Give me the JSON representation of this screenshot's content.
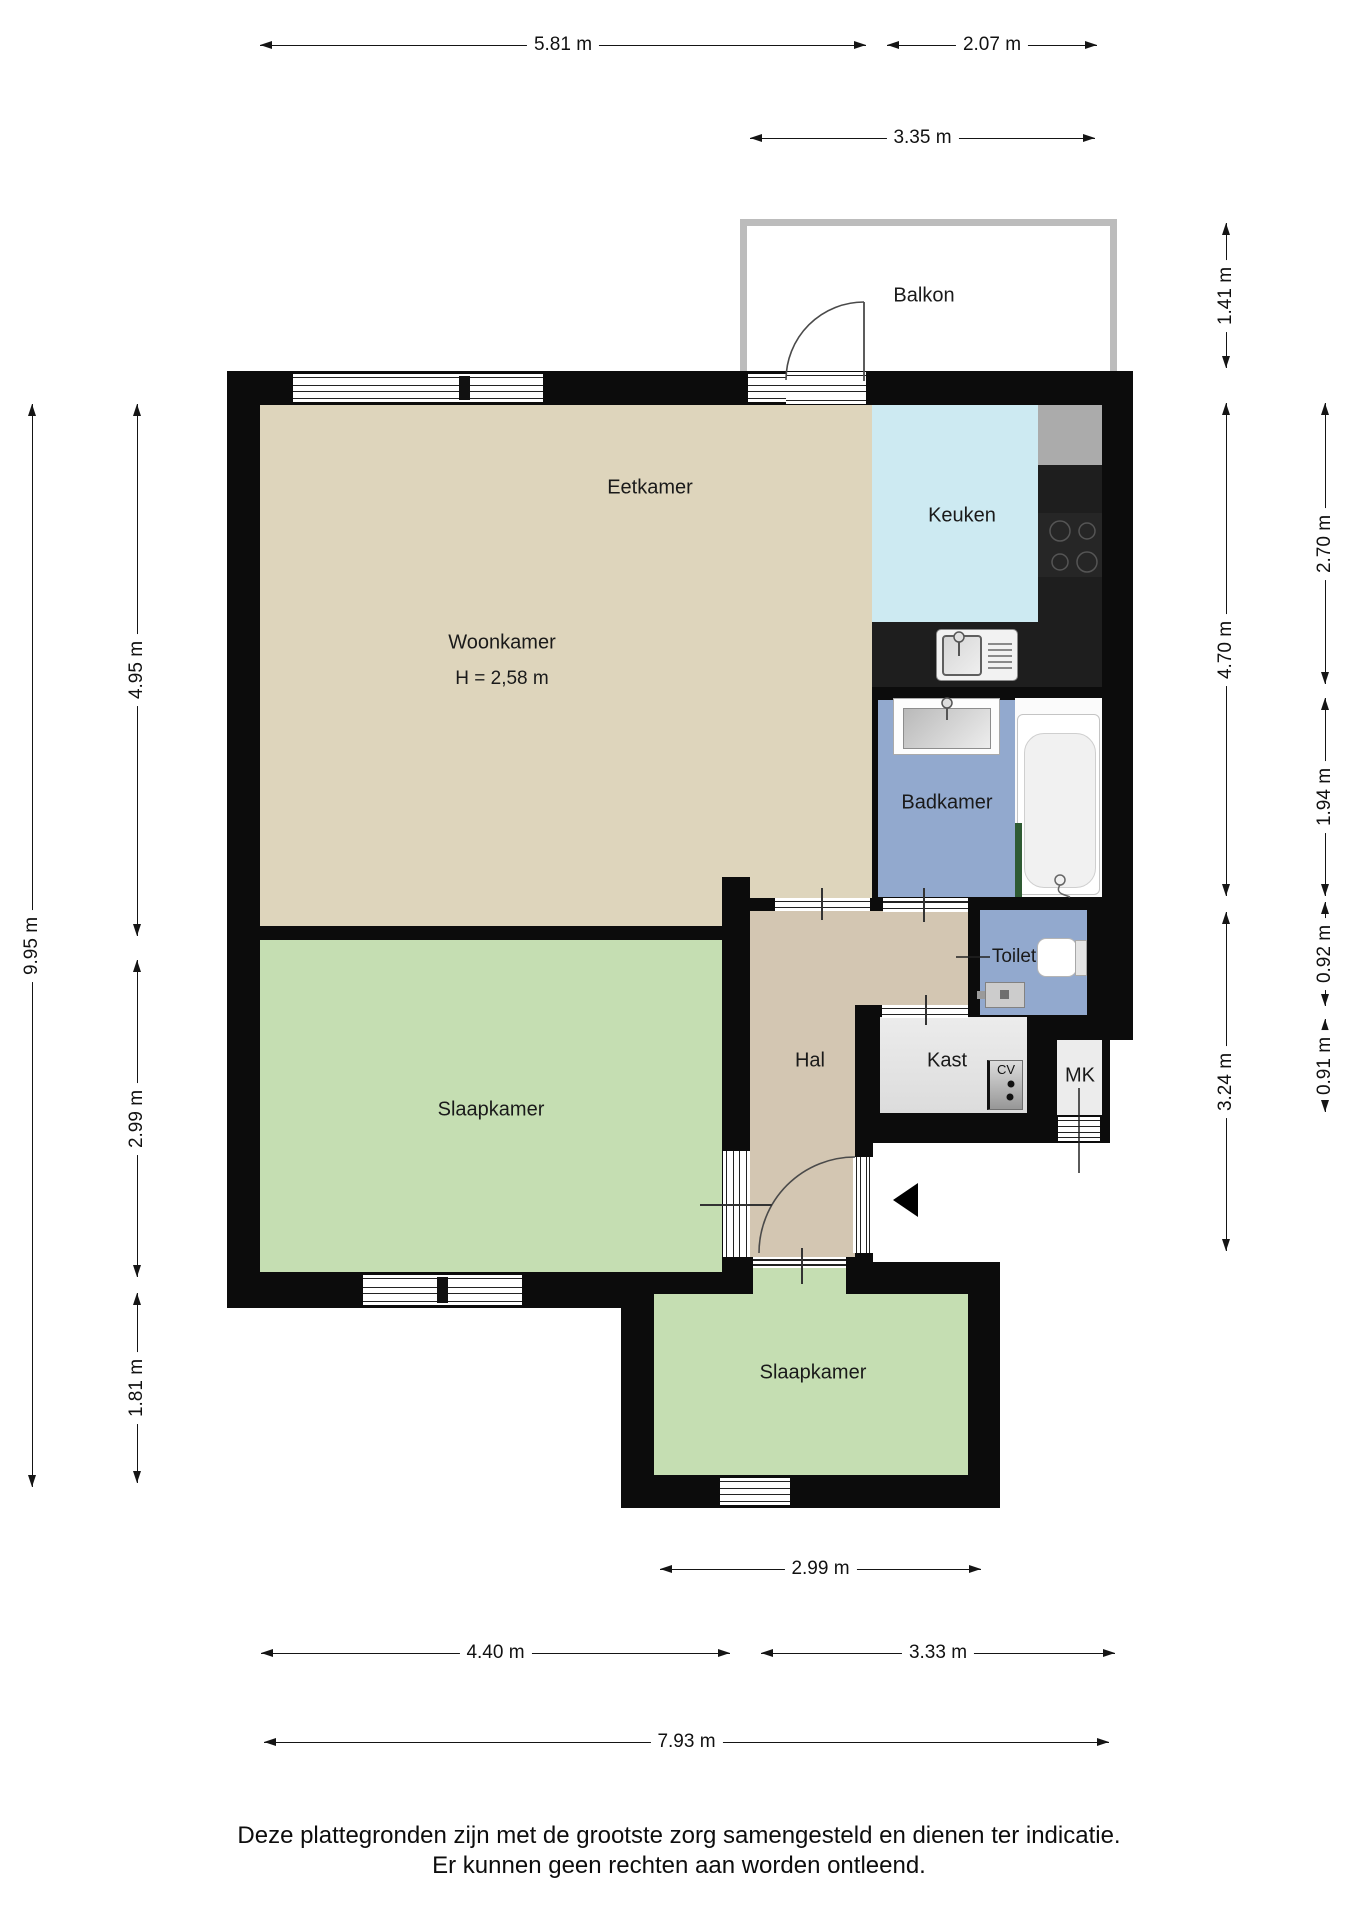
{
  "rooms": {
    "balkon": {
      "label": "Balkon"
    },
    "eetkamer": {
      "label": "Eetkamer"
    },
    "woonkamer": {
      "label": "Woonkamer",
      "ceiling_height": "H = 2,58 m"
    },
    "keuken": {
      "label": "Keuken"
    },
    "badkamer": {
      "label": "Badkamer"
    },
    "toilet": {
      "label": "Toilet"
    },
    "hal": {
      "label": "Hal"
    },
    "kast": {
      "label": "Kast"
    },
    "cv": {
      "label": "CV"
    },
    "mk": {
      "label": "MK"
    },
    "slaapkamer1": {
      "label": "Slaapkamer"
    },
    "slaapkamer2": {
      "label": "Slaapkamer"
    }
  },
  "dims": {
    "w581": "5.81 m",
    "w207": "2.07 m",
    "w335": "3.35 m",
    "h995": "9.95 m",
    "h495": "4.95 m",
    "h299": "2.99 m",
    "h181": "1.81 m",
    "h141": "1.41 m",
    "h470": "4.70 m",
    "h324": "3.24 m",
    "h270": "2.70 m",
    "h194": "1.94 m",
    "h092": "0.92 m",
    "h091": "0.91 m",
    "b299": "2.99 m",
    "b440": "4.40 m",
    "b333": "3.33 m",
    "b793": "7.93 m"
  },
  "disclaimer": {
    "line1": "Deze plattegronden zijn met de grootste zorg samengesteld en dienen ter indicatie.",
    "line2": "Er kunnen geen rechten aan worden ontleend."
  },
  "colors": {
    "wall": "#0c0c0c",
    "woonkamer_floor": "#ded5bc",
    "slaapkamer_floor": "#c5deb2",
    "keuken_floor": "#cdeaf2",
    "badkamer_floor": "#92a9ce",
    "hal_floor": "#d3c6b2",
    "kast_floor": "#e6e6e6",
    "counter": "#1e1e1e",
    "balkon_wall": "#bcbcbc"
  }
}
